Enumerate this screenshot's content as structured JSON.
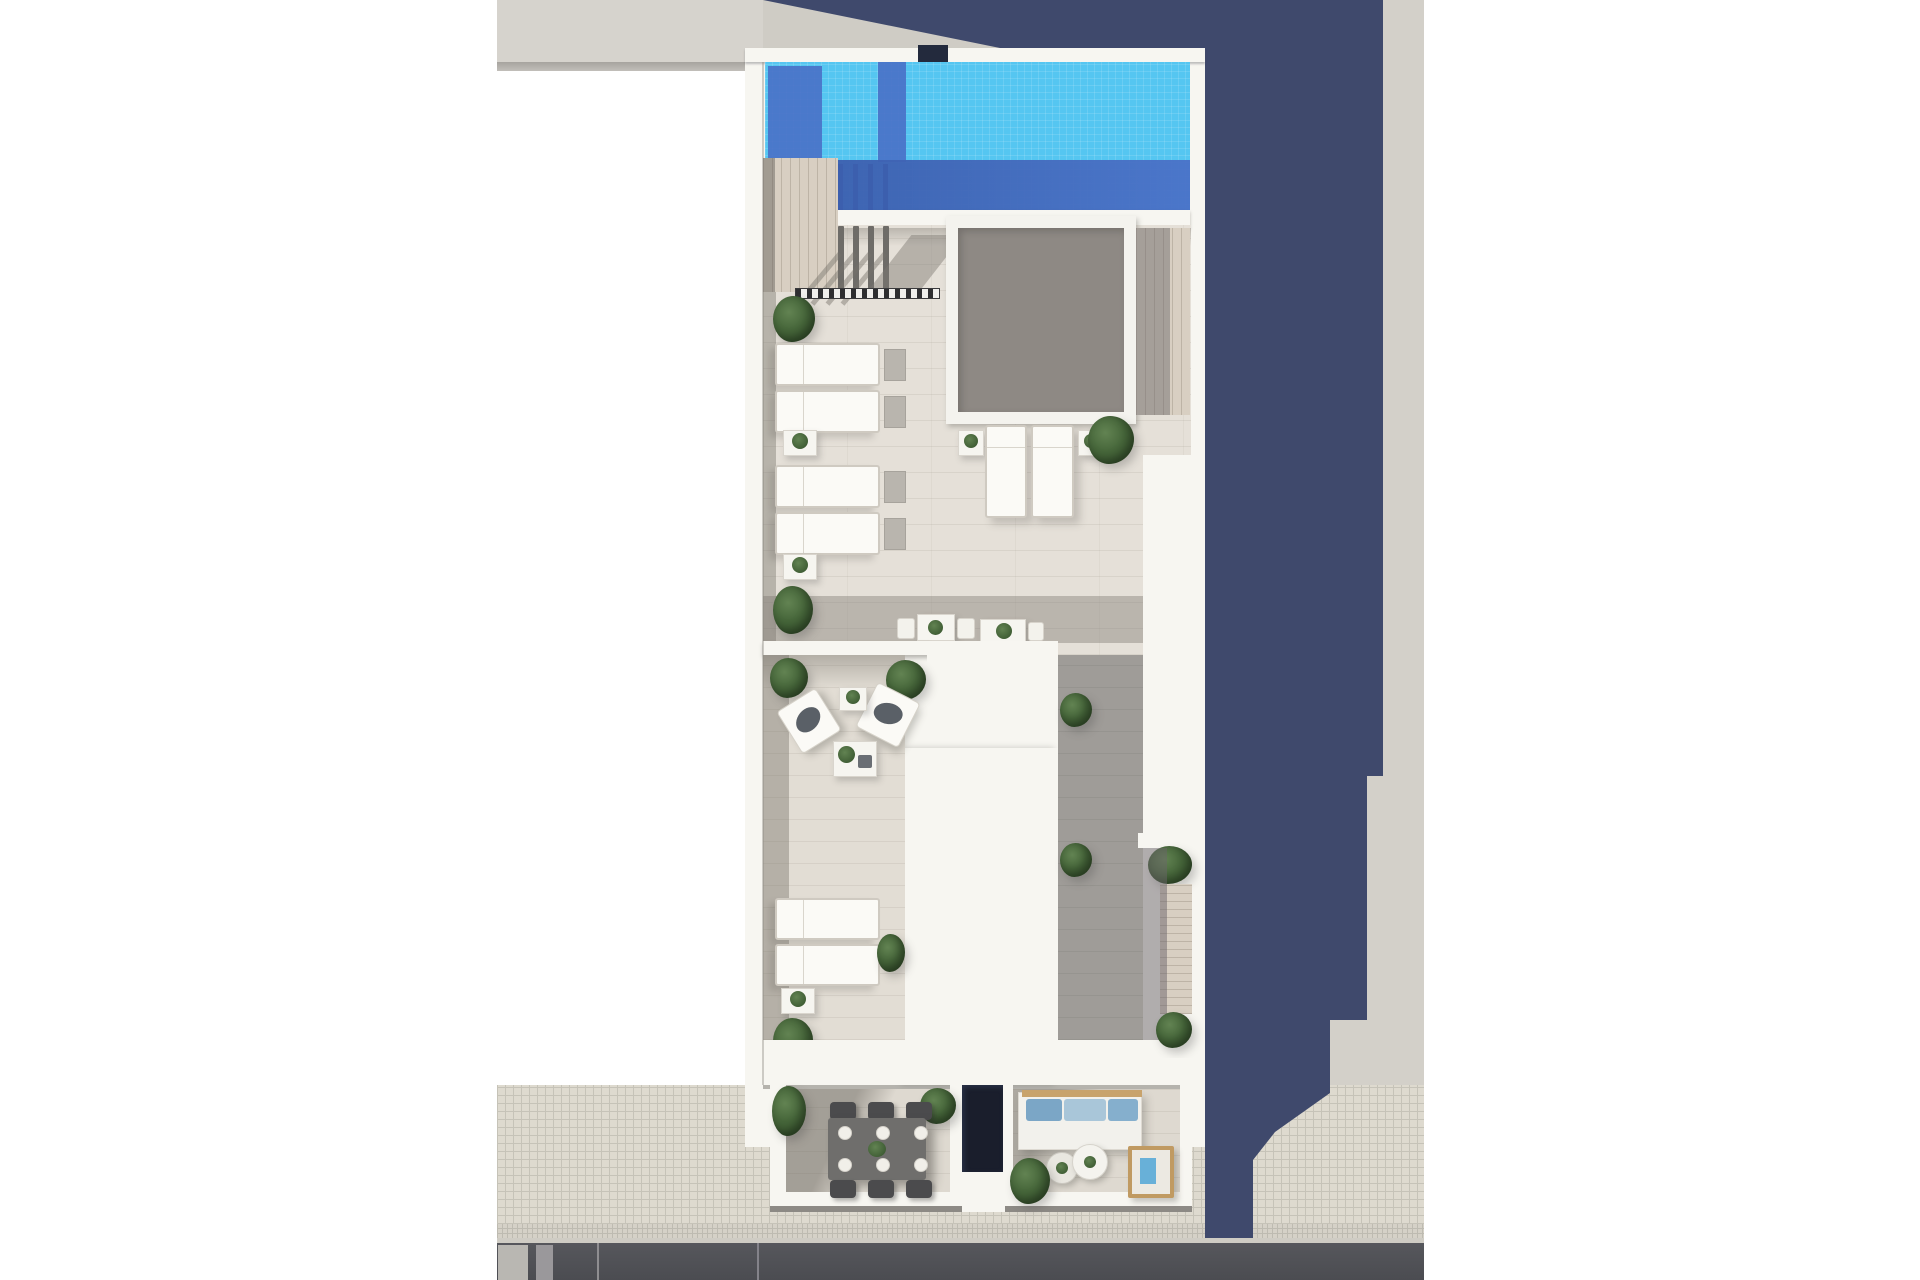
{
  "scene": {
    "kind": "aerial-3d-render",
    "subject": "rooftop terrace floor plan of a narrow residential building between party walls",
    "inventory": {
      "swimming_pool": 1,
      "skylight_courtyard_opening": 1,
      "sun_loungers_flat": 8,
      "cube_armchairs": 2,
      "bistro_table_sets": 2,
      "dining_table_seats": 6,
      "dinner_plates": 6,
      "garden_sofa_cushions": 3,
      "round_coffee_tables": 2,
      "wooden_deck_lounger": 1,
      "pergola_columns": 4,
      "planter_shrubs": 16,
      "lower_balconies": 2,
      "lightwell": 1
    }
  },
  "palette": {
    "margin": "#ffffff",
    "neighbor-roof": "#d6d3cd",
    "neighbor-edge": "#a7a49f",
    "neighbor-wall": "#eae7e0",
    "sunlit-ground": "#d3d0c9",
    "navy-shadow": "#3f496c",
    "wall-white": "#f7f6f1",
    "pool": "#55c6f1",
    "pool-shadow": "#4a72c8",
    "pool-deep": "#3c5fae",
    "entry-block": "#232a3d",
    "deck": "#e5e0d8",
    "wood": "#d8cfc2",
    "skylight": "#8e8984",
    "skylight-frame": "#f4f3ee",
    "corridor-shadow": "#9a959b",
    "lower-tile": "#e2ddd4",
    "terrace-tile": "#ded9d0",
    "lightwell": "#1a1e2c",
    "green-light": "#628352",
    "green-mid": "#46663a",
    "green-dark": "#33502a",
    "sofa-blue-1": "#7ba6c6",
    "sofa-blue-2": "#a9c6d9",
    "sofa-blue-3": "#85afcd",
    "wood-trim": "#c8a36c",
    "lounger-wood": "#c09a62",
    "towel-blue": "#68b0d8",
    "dining-table": "#6f6e6c",
    "chair": "#4b4b4d",
    "sidewalk": "#dedacf",
    "sidewalk-line": "#c6c3b8",
    "street": "#56575c",
    "curb": "#cfccc4"
  }
}
